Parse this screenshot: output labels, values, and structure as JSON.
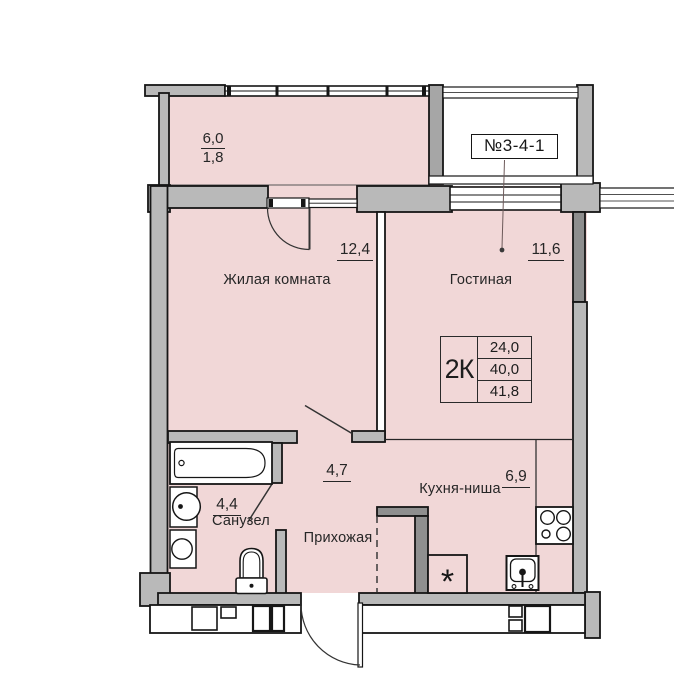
{
  "unit_badge": {
    "label": "№3-4-1"
  },
  "balcony": {
    "area_upper": "6,0",
    "area_lower": "1,8"
  },
  "rooms": {
    "living": {
      "name": "Жилая комната",
      "area": "12,4"
    },
    "lounge": {
      "name": "Гостиная",
      "area": "11,6"
    },
    "bathroom": {
      "name": "Санузел",
      "area": "4,4"
    },
    "hallway": {
      "name": "Прихожая",
      "area": "4,7"
    },
    "kitchen": {
      "name": "Кухня-ниша",
      "area": "6,9"
    }
  },
  "summary_table": {
    "unit_type": "2К",
    "living_area": "24,0",
    "apartment_area": "40,0",
    "total_area": "41,8"
  },
  "symbols": {
    "fridge": "*"
  },
  "colors": {
    "room_fill": "#f1d7d7",
    "wall_fill": "#b9b9b9",
    "wall_dark": "#8f8f8f",
    "outline": "#161616",
    "leader_line": "#6d5a5a"
  }
}
